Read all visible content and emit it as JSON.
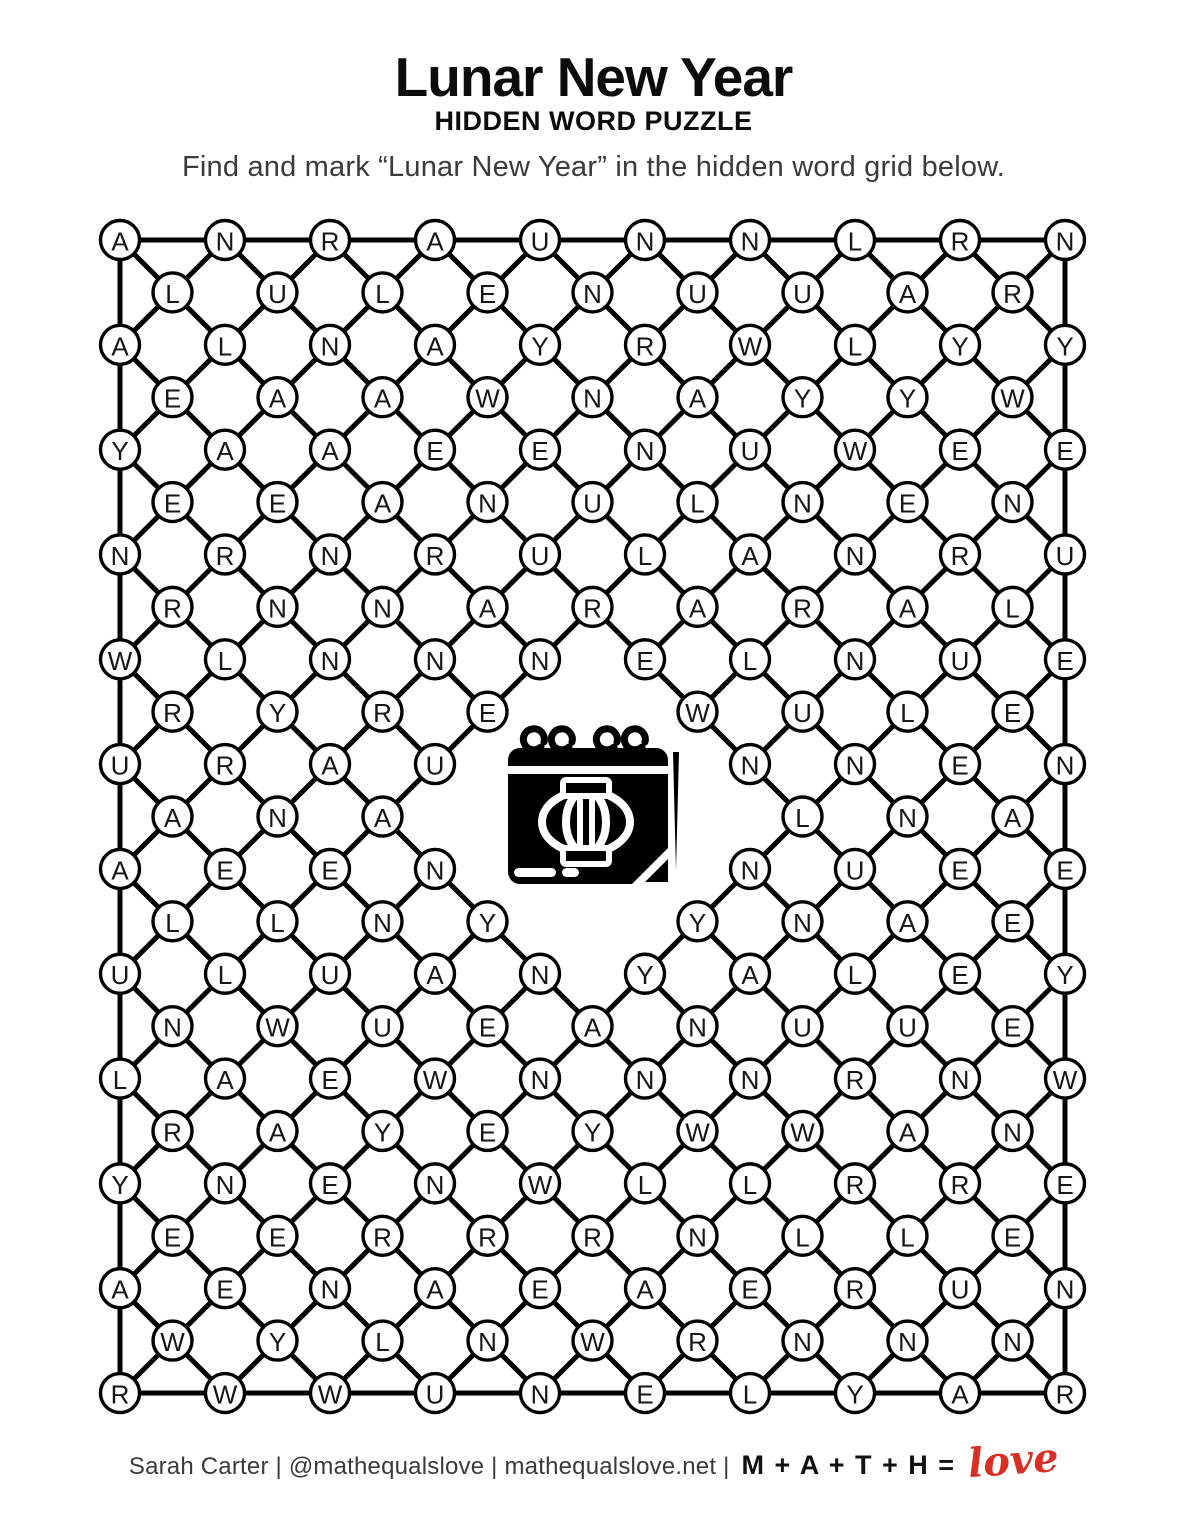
{
  "title": "Lunar New Year",
  "subtitle": "HIDDEN WORD PUZZLE",
  "instruction": "Find and mark “Lunar New Year” in the hidden word grid below.",
  "footer": {
    "credit": "Sarah Carter | @mathequalslove | mathequalslove.net |",
    "equation": "M + A + T + H =",
    "love_word": "love",
    "love_color": "#d93025"
  },
  "grid": {
    "hidden_word": "Lunar New Year",
    "center_icon": "calendar-with-paper-lantern-icon",
    "stroke_color": "#000000",
    "letter_color": "#161616",
    "rows": [
      [
        "A",
        "N",
        "R",
        "A",
        "U",
        "N",
        "N",
        "L",
        "R",
        "N"
      ],
      [
        "L",
        "U",
        "L",
        "E",
        "N",
        "U",
        "U",
        "A",
        "R"
      ],
      [
        "A",
        "L",
        "N",
        "A",
        "Y",
        "R",
        "W",
        "L",
        "Y",
        "Y"
      ],
      [
        "E",
        "A",
        "A",
        "W",
        "N",
        "A",
        "Y",
        "Y",
        "W"
      ],
      [
        "Y",
        "A",
        "A",
        "E",
        "E",
        "N",
        "U",
        "W",
        "E",
        "E"
      ],
      [
        "E",
        "E",
        "A",
        "N",
        "U",
        "L",
        "N",
        "E",
        "N"
      ],
      [
        "N",
        "R",
        "N",
        "R",
        "U",
        "L",
        "A",
        "N",
        "R",
        "U"
      ],
      [
        "R",
        "N",
        "N",
        "A",
        "R",
        "A",
        "R",
        "A",
        "L"
      ],
      [
        "W",
        "L",
        "N",
        "N",
        "N",
        "E",
        "L",
        "N",
        "U",
        "E"
      ],
      [
        "R",
        "Y",
        "R",
        "E",
        null,
        "W",
        "U",
        "L",
        "E"
      ],
      [
        "U",
        "R",
        "A",
        "U",
        null,
        null,
        "N",
        "N",
        "E",
        "N"
      ],
      [
        "A",
        "N",
        "A",
        null,
        null,
        null,
        "L",
        "N",
        "A"
      ],
      [
        "A",
        "E",
        "E",
        "N",
        null,
        null,
        "N",
        "U",
        "E",
        "E"
      ],
      [
        "L",
        "L",
        "N",
        "Y",
        null,
        "Y",
        "N",
        "A",
        "E"
      ],
      [
        "U",
        "L",
        "U",
        "A",
        "N",
        "Y",
        "A",
        "L",
        "E",
        "Y"
      ],
      [
        "N",
        "W",
        "U",
        "E",
        "A",
        "N",
        "U",
        "U",
        "E"
      ],
      [
        "L",
        "A",
        "E",
        "W",
        "N",
        "N",
        "N",
        "R",
        "N",
        "W"
      ],
      [
        "R",
        "A",
        "Y",
        "E",
        "Y",
        "W",
        "W",
        "A",
        "N"
      ],
      [
        "Y",
        "N",
        "E",
        "N",
        "W",
        "L",
        "L",
        "R",
        "R",
        "E"
      ],
      [
        "E",
        "E",
        "R",
        "R",
        "R",
        "N",
        "L",
        "L",
        "E"
      ],
      [
        "A",
        "E",
        "N",
        "A",
        "E",
        "A",
        "E",
        "R",
        "U",
        "N"
      ],
      [
        "W",
        "Y",
        "L",
        "N",
        "W",
        "R",
        "N",
        "N",
        "N"
      ],
      [
        "R",
        "W",
        "W",
        "U",
        "N",
        "E",
        "L",
        "Y",
        "A",
        "R"
      ]
    ]
  }
}
